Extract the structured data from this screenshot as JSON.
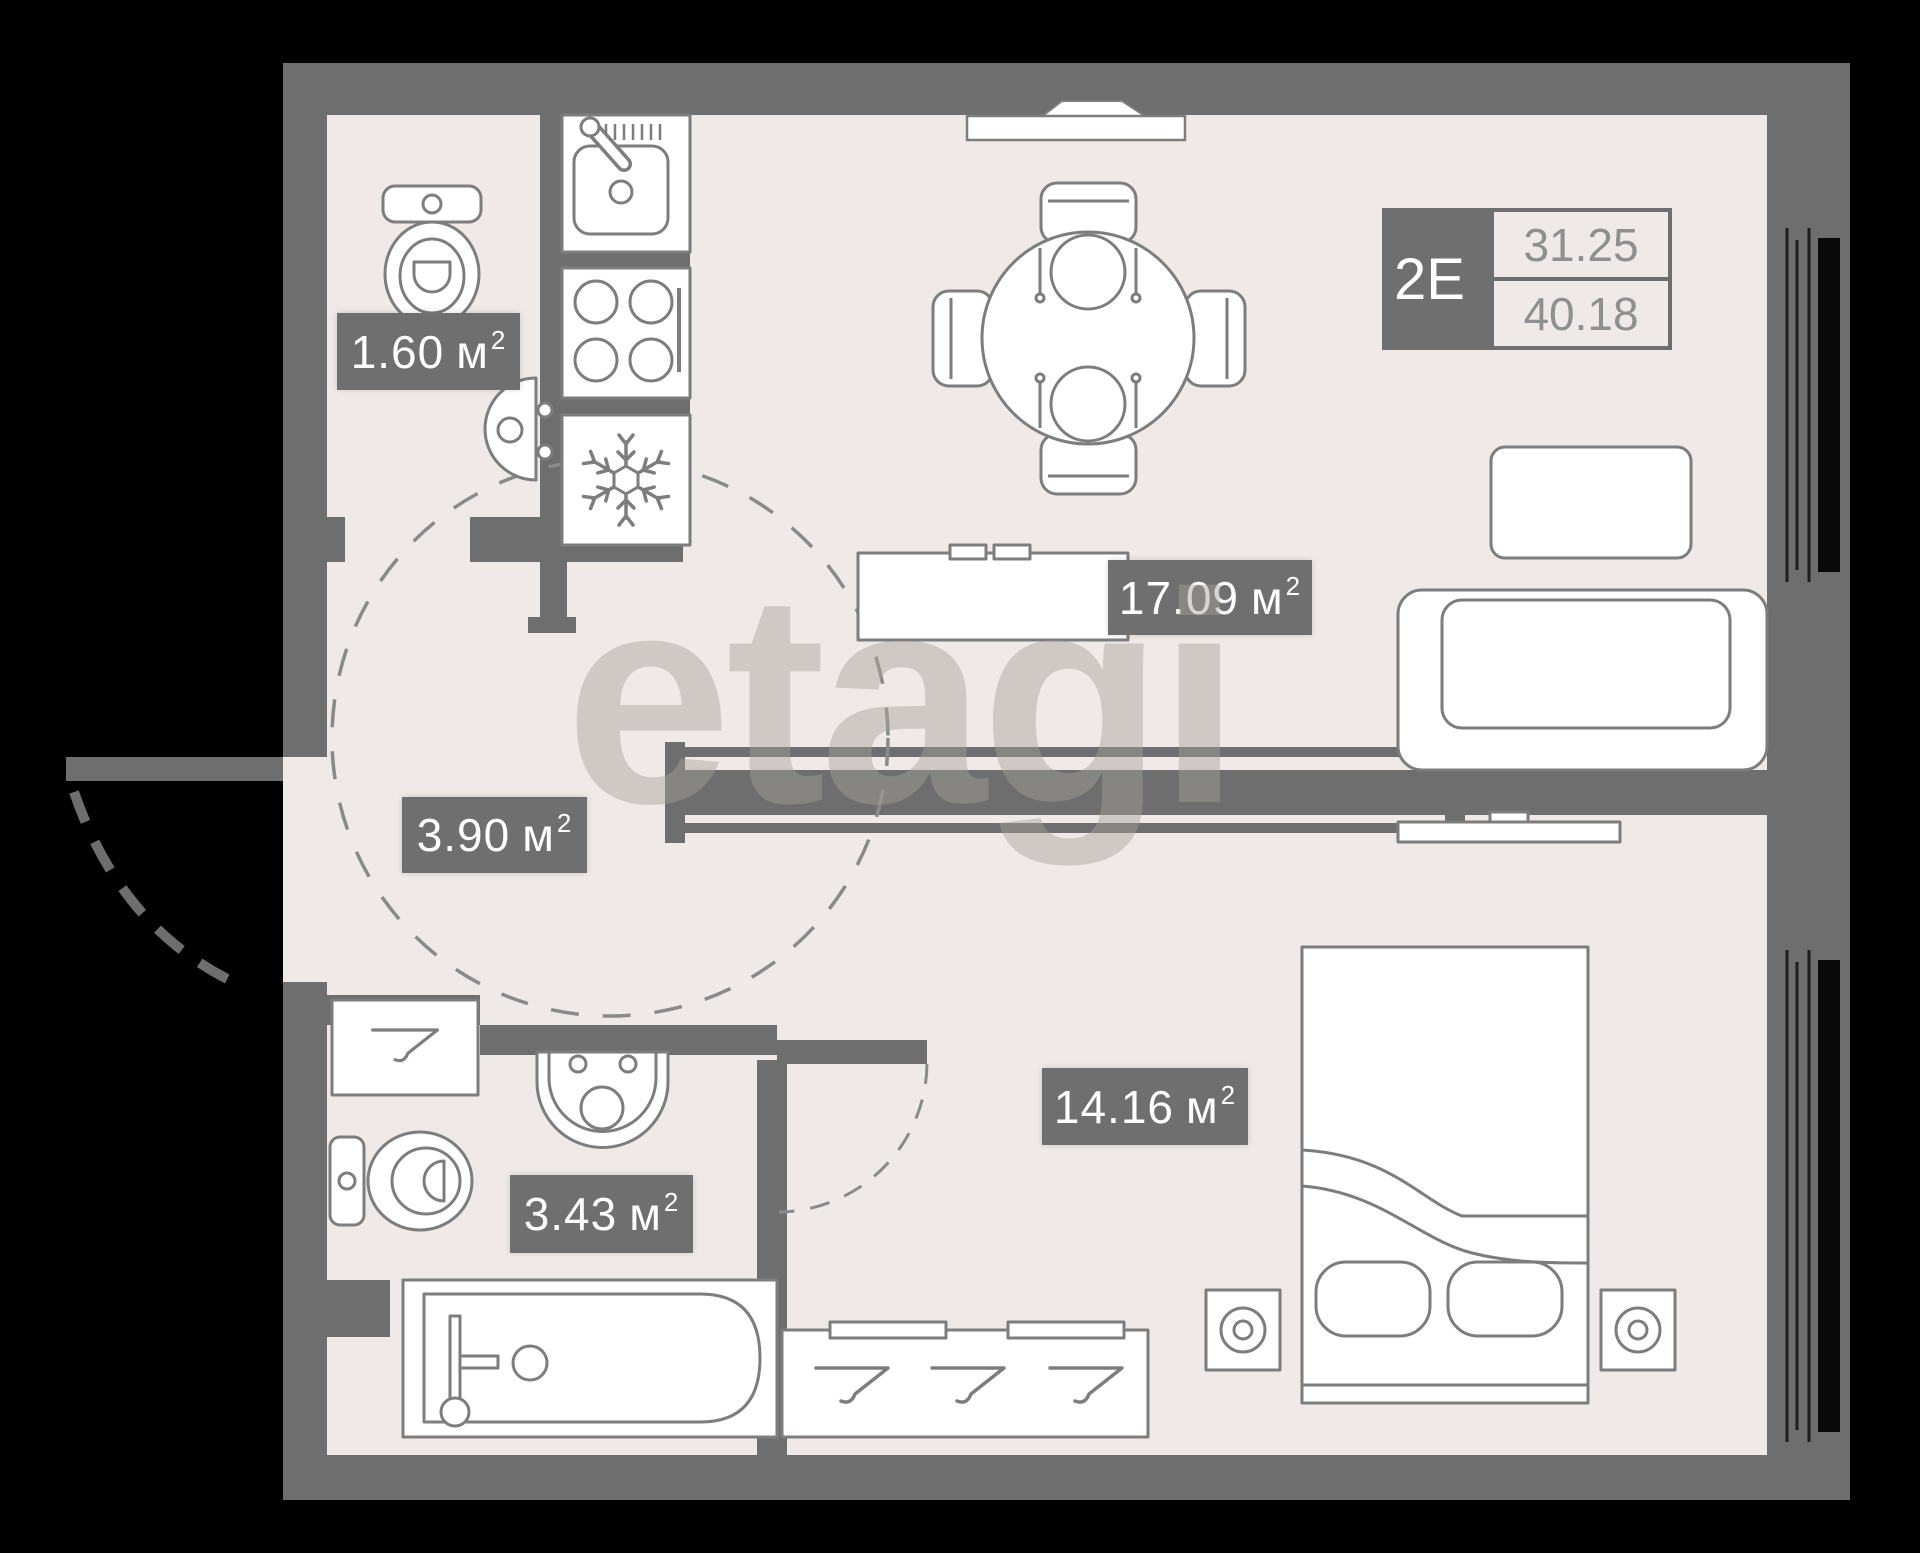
{
  "watermark": {
    "text": "etagi"
  },
  "unit_info": {
    "code": "2Е",
    "living_area": "31.25",
    "total_area": "40.18"
  },
  "rooms": [
    {
      "id": "wc",
      "area": "1.60",
      "unit": "м",
      "sup": "2"
    },
    {
      "id": "hallway",
      "area": "3.90",
      "unit": "м",
      "sup": "2"
    },
    {
      "id": "kitchen-living",
      "area": "17.09",
      "unit": "м",
      "sup": "2"
    },
    {
      "id": "bathroom",
      "area": "3.43",
      "unit": "м",
      "sup": "2"
    },
    {
      "id": "bedroom",
      "area": "14.16",
      "unit": "м",
      "sup": "2"
    }
  ],
  "colors": {
    "background": "#000000",
    "floor": "#efeae7",
    "wall": "#6e6e6e",
    "label_bg": "#6f6f6f",
    "label_text": "#ffffff",
    "furniture_stroke": "#7d7d7d",
    "furniture_fill": "#ffffff",
    "value_text": "#8f8f8f",
    "watermark": "#a7a19c"
  }
}
